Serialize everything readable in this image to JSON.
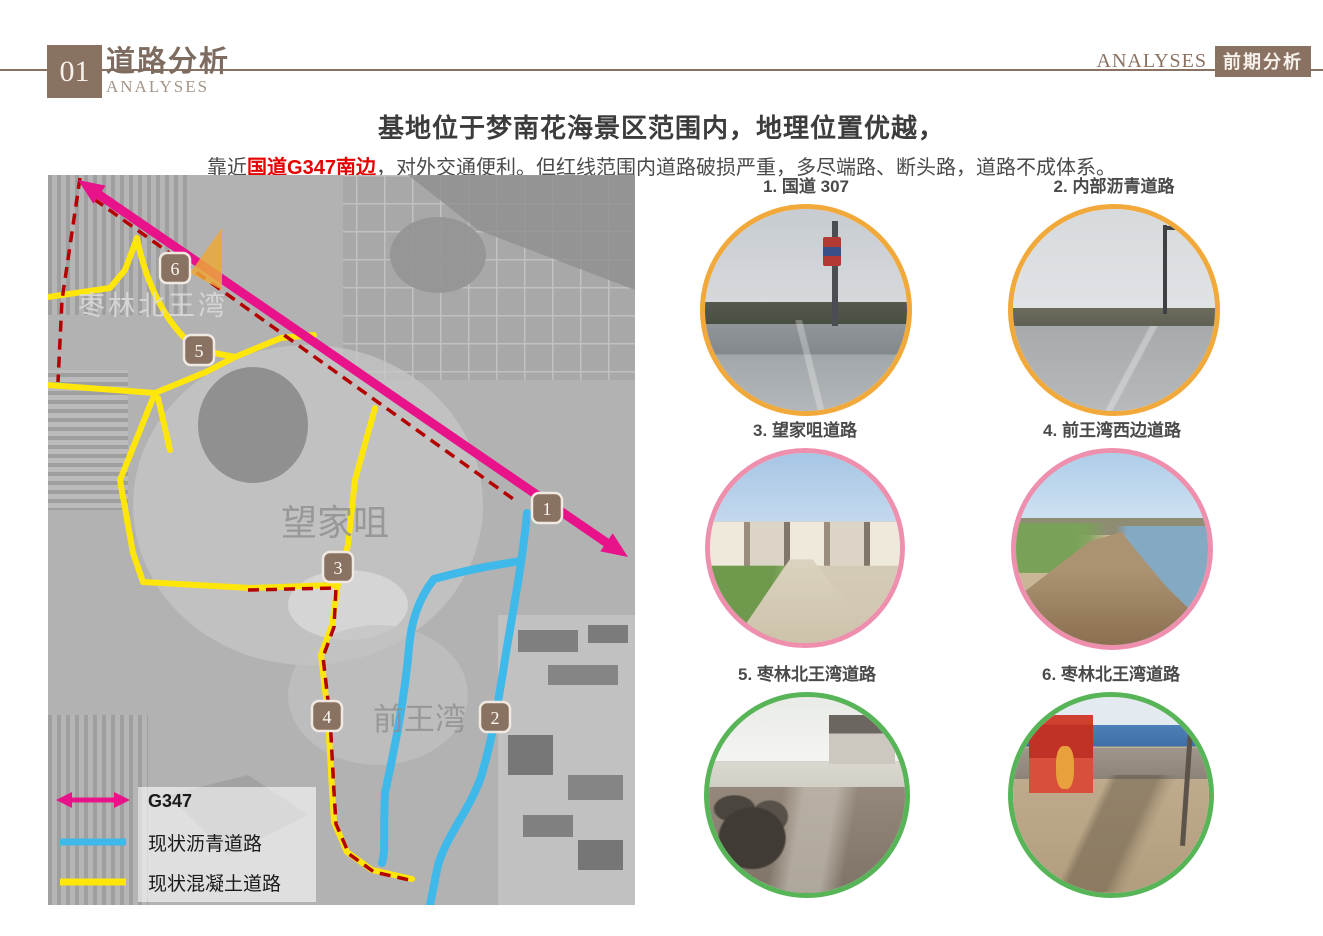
{
  "header": {
    "number": "01",
    "title_cn": "道路分析",
    "title_en": "ANALYSES",
    "right_en": "ANALYSES",
    "right_tag": "前期分析"
  },
  "intro": {
    "headline": "基地位于梦南花海景区范围内，地理位置优越，",
    "line_pre": "靠近",
    "line_highlight": "国道G347南边",
    "line_post": "，对外交通便利。但红线范围内道路破损严重，多尽端路、断头路，道路不成体系。"
  },
  "map": {
    "place_labels": {
      "north": "枣林北王湾",
      "middle": "望家咀",
      "south": "前王湾"
    },
    "markers": {
      "m1": "1",
      "m2": "2",
      "m3": "3",
      "m4": "4",
      "m5": "5",
      "m6": "6"
    },
    "legend": {
      "g347": "G347",
      "asphalt": "现状沥青道路",
      "concrete": "现状混凝土道路"
    },
    "colors": {
      "g347": "#e8128a",
      "asphalt": "#3fb8ea",
      "concrete": "#ffe60a",
      "boundary": "#b40000",
      "marker": "#8a7263"
    }
  },
  "photos": {
    "p1": {
      "caption": "1. 国道 307",
      "ring": "#f2a93b"
    },
    "p2": {
      "caption": "2. 内部沥青道路",
      "ring": "#f2a93b"
    },
    "p3": {
      "caption": "3. 望家咀道路",
      "ring": "#ef8fae"
    },
    "p4": {
      "caption": "4. 前王湾西边道路",
      "ring": "#ef8fae"
    },
    "p5": {
      "caption": "5. 枣林北王湾道路",
      "ring": "#57b558"
    },
    "p6": {
      "caption": "6. 枣林北王湾道路",
      "ring": "#57b558"
    }
  }
}
